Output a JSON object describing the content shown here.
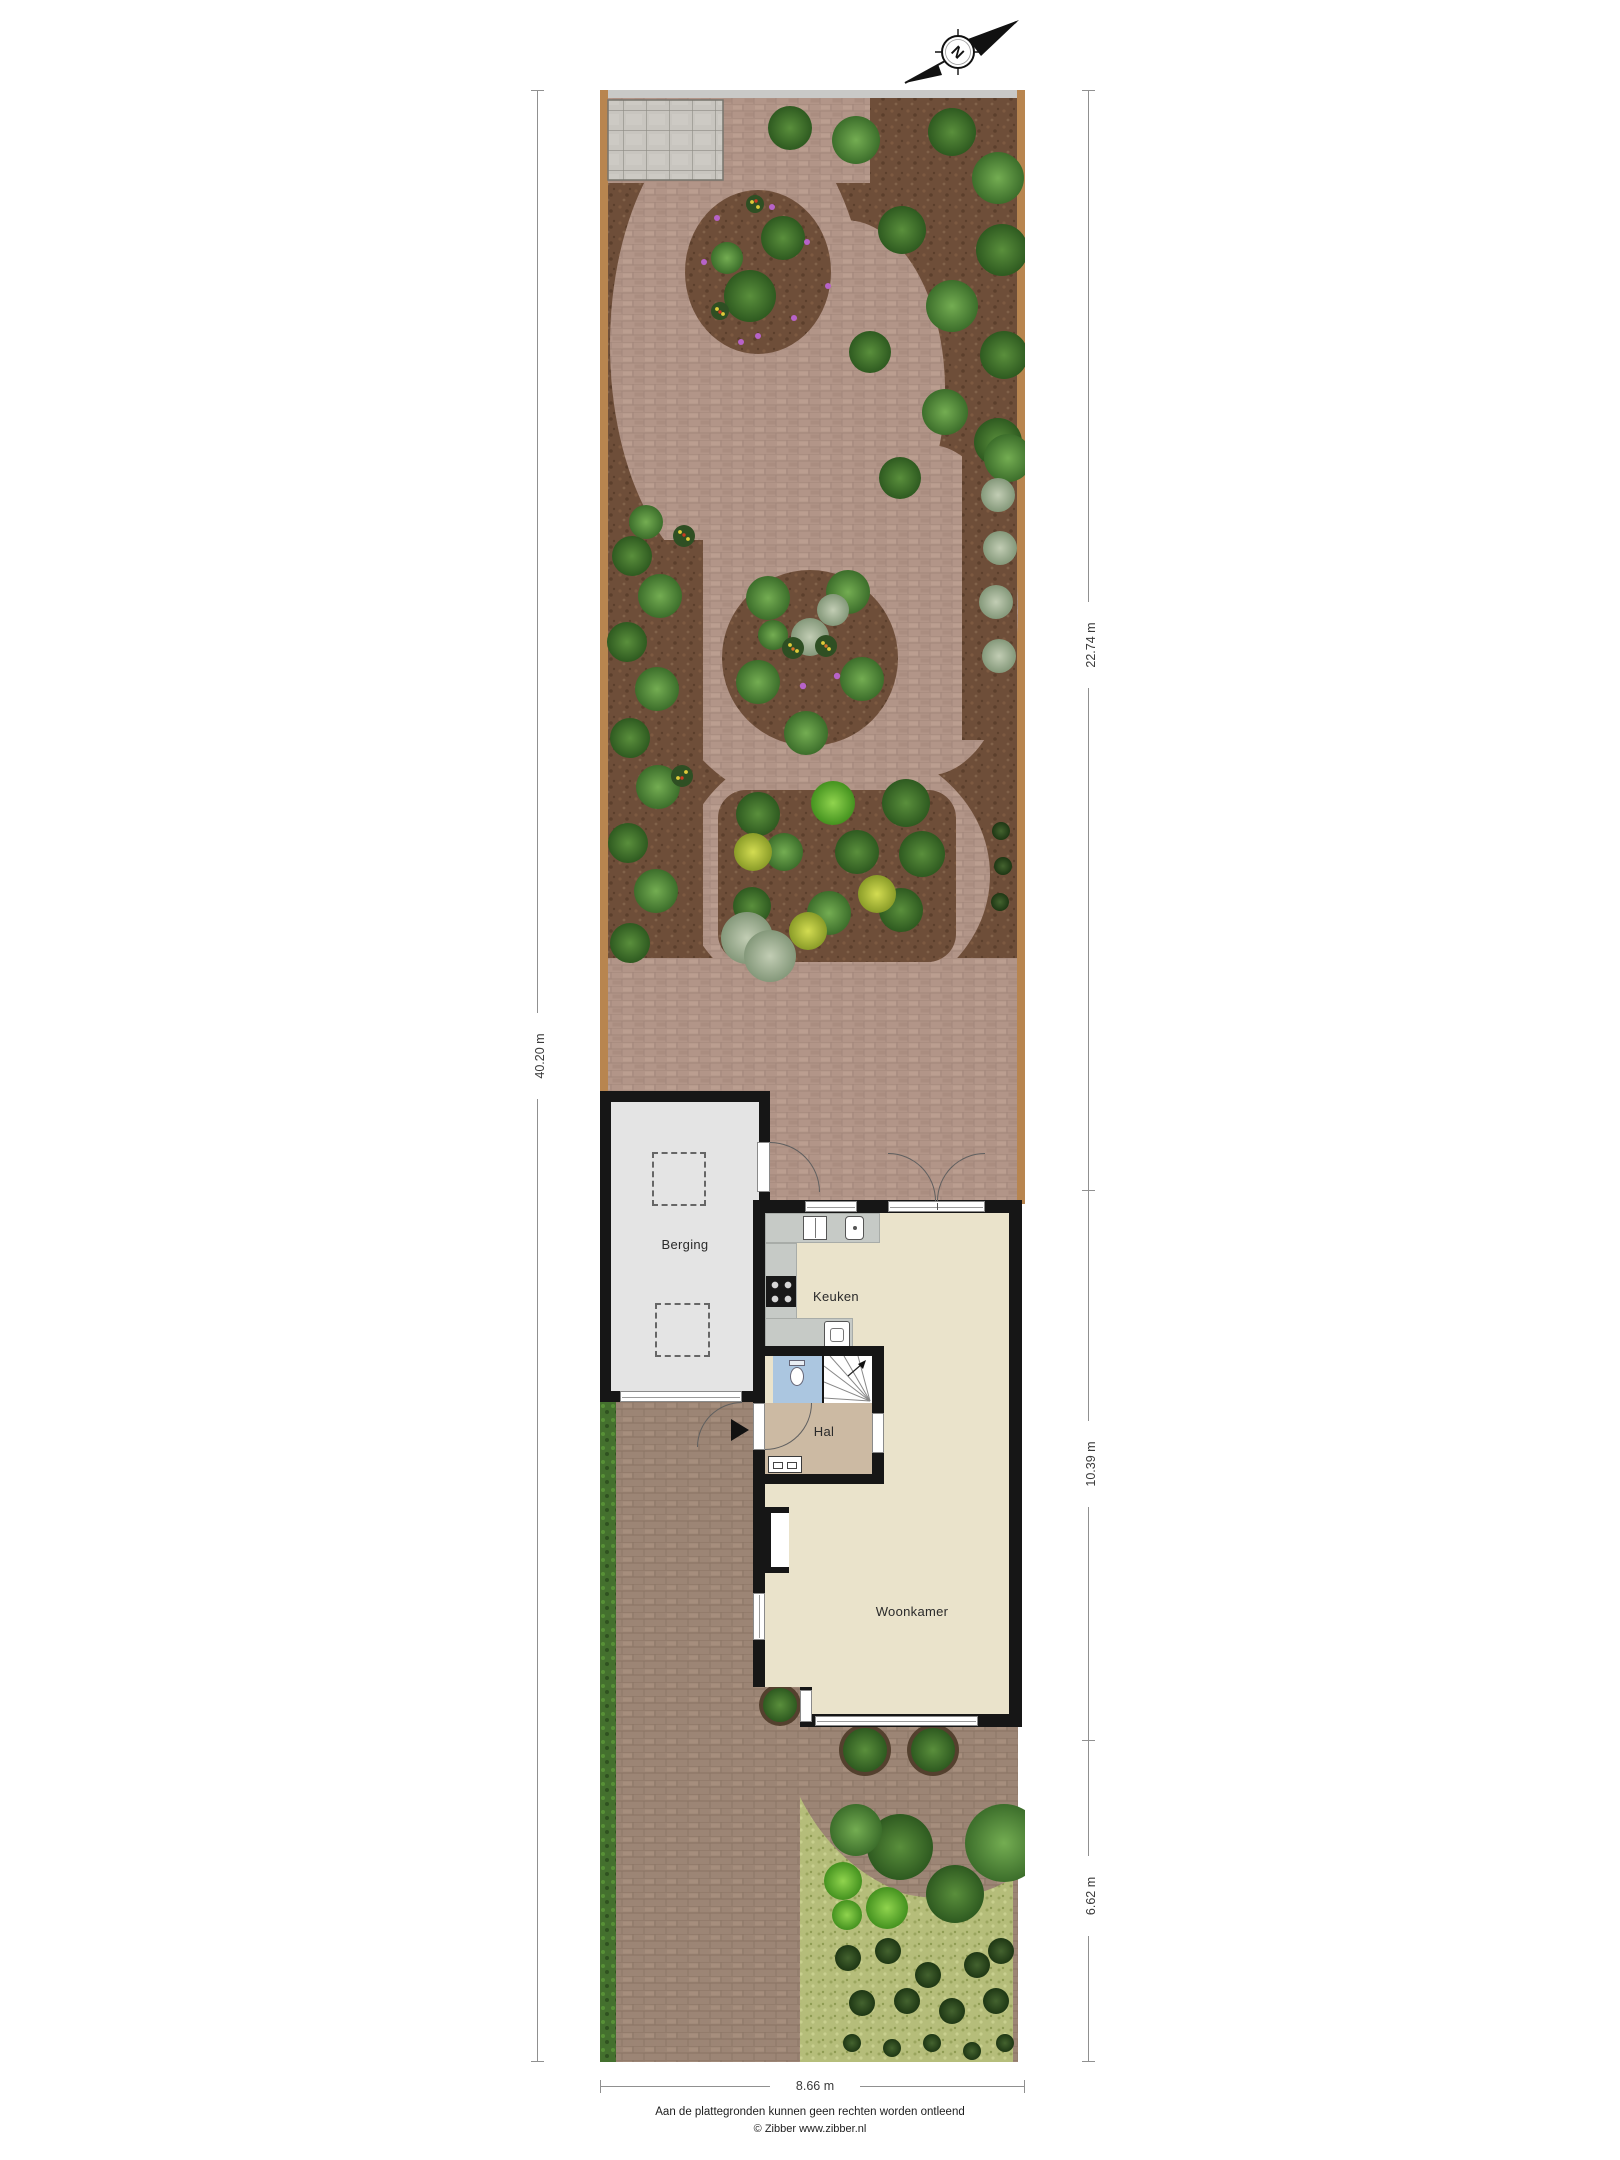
{
  "compass": {
    "letter": "N"
  },
  "rooms": {
    "berging": "Berging",
    "keuken": "Keuken",
    "hal": "Hal",
    "woonkamer": "Woonkamer"
  },
  "dimensions": {
    "plot_length": "40.20 m",
    "garden_depth": "22.74 m",
    "house_depth": "10.39 m",
    "front_depth": "6.62 m",
    "plot_width": "8.66 m"
  },
  "footer": {
    "disclaimer": "Aan de plattegronden kunnen geen rechten worden ontleend",
    "credit": "© Zibber www.zibber.nl"
  },
  "colors": {
    "wall": "#161616",
    "floor": "#eae3cb",
    "hal": "#ccbaa3",
    "toilet": "#abc6e0",
    "berging": "#e4e4e4",
    "counter": "#c6cac6",
    "mulch": "#6e4e39",
    "brick": "#b29588",
    "drive": "#9c8575",
    "grass": "#b5bd7a",
    "hedge": "#44702e",
    "wood": "#b8854f",
    "patio": "#c8c5bf",
    "fence": "#c9c9c7",
    "dimline": "#909090",
    "text": "#2a2a2a"
  }
}
